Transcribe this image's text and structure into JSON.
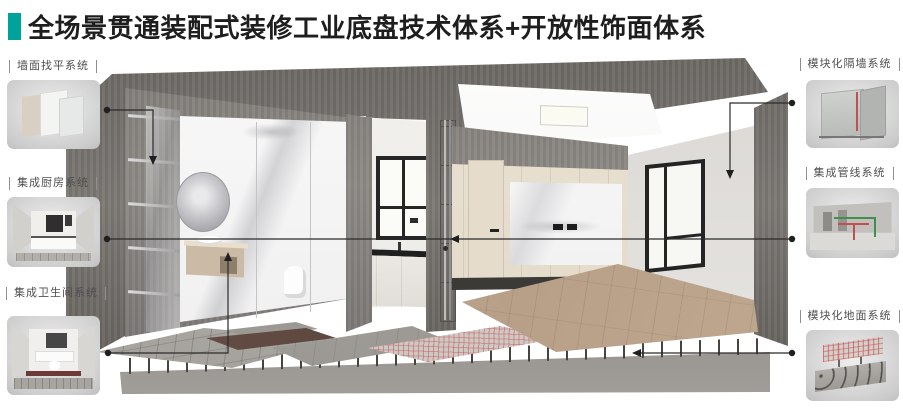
{
  "title": {
    "text": "全场景贯通装配式装修工业底盘技术体系+开放性饰面体系",
    "accent_color": "#00a39b"
  },
  "callouts": {
    "left": [
      {
        "label": "墙面找平系统",
        "icon": "wall-leveling-thumbnail"
      },
      {
        "label": "集成厨房系统",
        "icon": "integrated-kitchen-thumbnail"
      },
      {
        "label": "集成卫生间系统",
        "icon": "integrated-bathroom-thumbnail"
      }
    ],
    "right": [
      {
        "label": "模块化隔墙系统",
        "icon": "modular-partition-thumbnail"
      },
      {
        "label": "集成管线系统",
        "icon": "integrated-piping-thumbnail"
      },
      {
        "label": "模块化地面系统",
        "icon": "modular-floor-thumbnail"
      }
    ]
  },
  "colors": {
    "accent": "#00a39b",
    "leader_line": "#2b2b2b",
    "label_text": "#4f4f4f",
    "heating_coil": "#cd5555",
    "pipe_green": "#3f8f4f",
    "pipe_red": "#c0504d"
  }
}
